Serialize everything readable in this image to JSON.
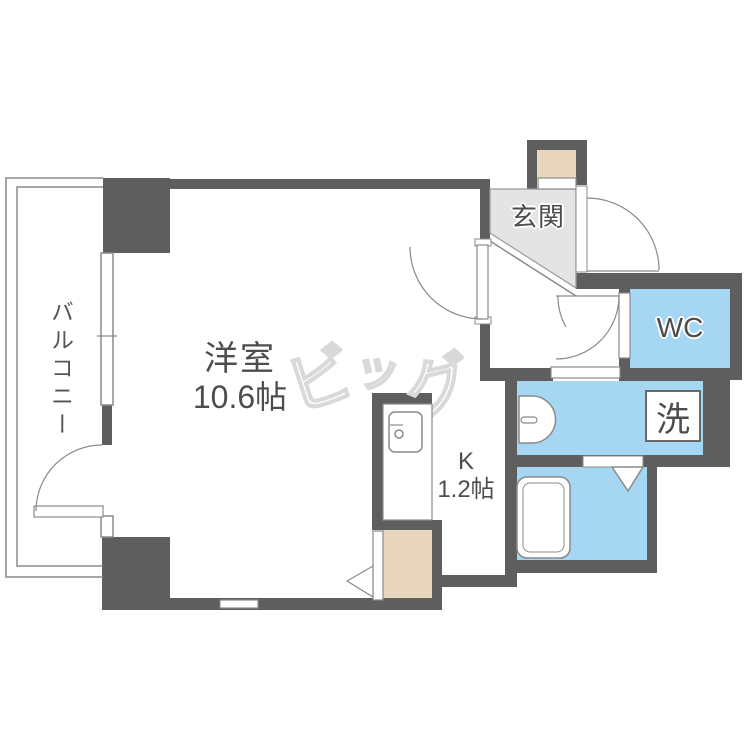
{
  "plan_title": "1K apartment floor plan",
  "rooms": {
    "main_room": {
      "name": "洋室",
      "size": "10.6帖"
    },
    "balcony": {
      "name": "バルコニー"
    },
    "entrance": {
      "name": "玄関"
    },
    "toilet": {
      "name": "WC"
    },
    "laundry": {
      "name": "洗"
    },
    "kitchen": {
      "name": "K",
      "size": "1.2帖"
    }
  },
  "watermark": {
    "char1": "ビ",
    "char2": "ッ",
    "char3": "グ",
    "full_text": "ビッグ"
  },
  "colors": {
    "wall": "#5e5e5e",
    "water": "#a6d7f2",
    "storage": "#e9d7bd",
    "genkan": "#e4e4e4",
    "line": "#8a8a8a",
    "text": "#4d4d4d",
    "mark": "#d9d9d9"
  }
}
